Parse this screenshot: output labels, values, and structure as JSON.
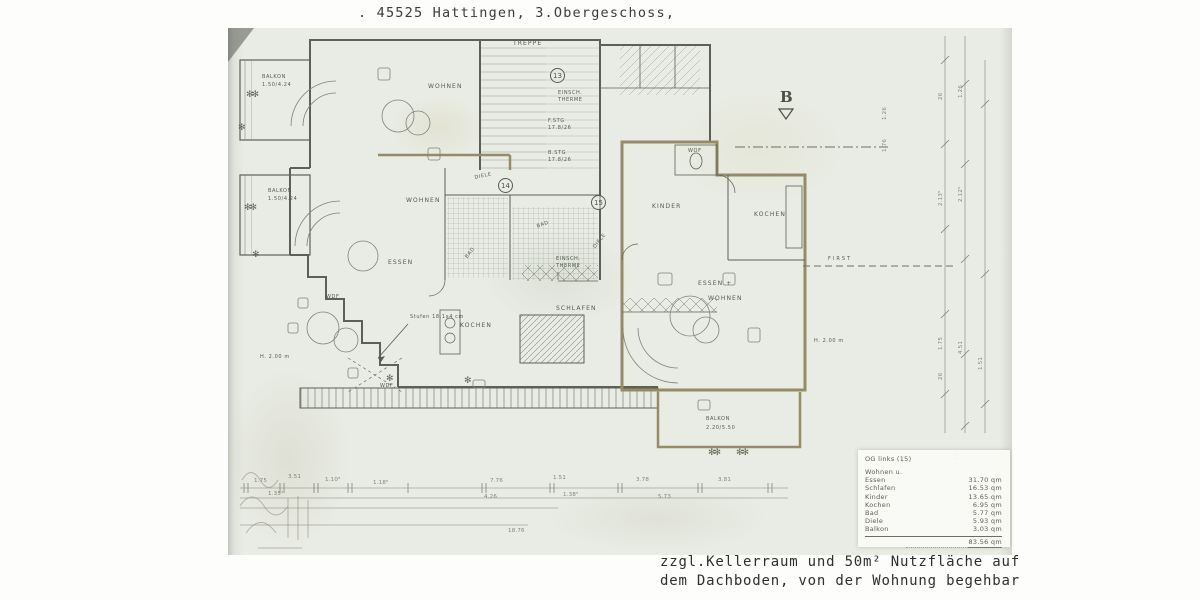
{
  "colors": {
    "paper": "#e9ece4",
    "ink": "#5d6057",
    "accent_wall": "#958c66",
    "dim_lines": "#7a8076"
  },
  "header": {
    "title": ". 45525 Hattingen, 3.Obergeschoss,"
  },
  "footer": {
    "line1": "zzgl.Kellerraum und 50m² Nutzfläche auf",
    "line2": "dem Dachboden, von der Wohnung begehbar"
  },
  "icons": {
    "plant": "✻✻",
    "plant_small": "✻"
  },
  "plan": {
    "units": {
      "u13": "13",
      "u14": "14",
      "u15": "15"
    },
    "section_marker": "B",
    "labels": {
      "treppe": "TREPPE",
      "stg_f": "F.STG",
      "stg_f_val": "17.8/26",
      "stg_b": "B.STG",
      "stg_b_val": "17.8/26",
      "wohnen_tl": "WOHNEN",
      "balkon1": "BALKON",
      "balkon1_dim": "1.50/4.24",
      "balkon2": "BALKON",
      "balkon2_dim": "1.50/4.24",
      "wohnen_ml": "WOHNEN",
      "essen_l": "ESSEN",
      "kochen_l": "KOCHEN",
      "schlafen": "SCHLAFEN",
      "bad1": "BAD",
      "bad2": "BAD",
      "diele1": "DIELE",
      "diele2": "DIELE",
      "therme1a": "EINSCH.",
      "therme1b": "THERME",
      "therme2a": "EINSCH.",
      "therme2b": "THERME",
      "kinder": "KINDER",
      "kochen_r": "KOCHEN",
      "essen_r": "ESSEN +",
      "wohnen_r": "WOHNEN",
      "wof": "WOF",
      "wdf1": "WDF",
      "wdf2": "WDF",
      "balkon3": "BALKON",
      "balkon3_dim": "2.20/5.50",
      "stufen": "Stufen 18.1x4 cm",
      "first": "FIRST",
      "h_right": "H. 2.00 m",
      "h_left": "H. 2.00 m"
    },
    "dims_bottom": [
      "1.75",
      "3.51",
      "1.35¹",
      "1.10⁵",
      "1.18⁵",
      "7.76",
      "4.26",
      "1.51",
      "1.38⁵",
      "3.78",
      "5.73",
      "3.81"
    ],
    "dims_bottom_total": "18.76",
    "dims_right": [
      "26",
      "2.13⁵",
      "1.26",
      "2.12⁵",
      "1.75",
      "4.51",
      "26",
      "4.13⁵",
      "1.51",
      "3.85",
      "1.26",
      "1.76"
    ]
  },
  "area_table": {
    "title": "OG links (15)",
    "rows": [
      {
        "label": "Wohnen u.",
        "value": ""
      },
      {
        "label": "Essen",
        "value": "31.70 qm"
      },
      {
        "label": "Schlafen",
        "value": "16.53 qm"
      },
      {
        "label": "Kinder",
        "value": "13.65 qm"
      },
      {
        "label": "Kochen",
        "value": "6.95 qm"
      },
      {
        "label": "Bad",
        "value": "5.77 qm"
      },
      {
        "label": "Diele",
        "value": "5.93 qm"
      },
      {
        "label": "Balkon",
        "value": "3.03 qm"
      }
    ],
    "total": "83.56 qm"
  }
}
